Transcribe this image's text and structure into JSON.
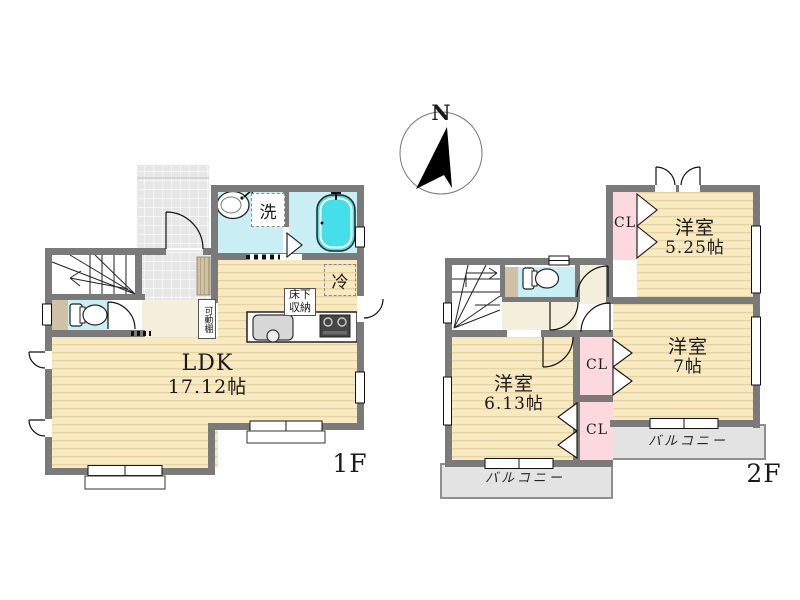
{
  "compass": {
    "north_label": "N"
  },
  "floor1": {
    "floor_label": "1F",
    "ldk": {
      "name": "LDK",
      "size": "17.12帖"
    },
    "washroom_label": "洗",
    "fridge_label": "冷",
    "underfloor_storage_label": "床下収納",
    "movable_shelf_label": "可動棚"
  },
  "floor2": {
    "floor_label": "2F",
    "bedroom_a": {
      "name": "洋室",
      "size": "5.25帖"
    },
    "bedroom_b": {
      "name": "洋室",
      "size": "7帖"
    },
    "bedroom_c": {
      "name": "洋室",
      "size": "6.13帖"
    },
    "closet_a_label": "CL",
    "closet_b_label": "CL",
    "closet_c_label": "CL",
    "balcony_a_label": "バルコニー",
    "balcony_b_label": "バルコニー"
  },
  "colors": {
    "wall": "#7a7a7a",
    "wood_floor": "#f7e9c2",
    "tile": "#e9e9e9",
    "wet_area": "#c9eef4",
    "bathtub": "#45dfe9",
    "closet_pink": "#fbd9de",
    "balcony_gray": "#e3e3e3",
    "hall_cream": "#f4eedd",
    "cabinet_tan": "#cfc0a6"
  }
}
